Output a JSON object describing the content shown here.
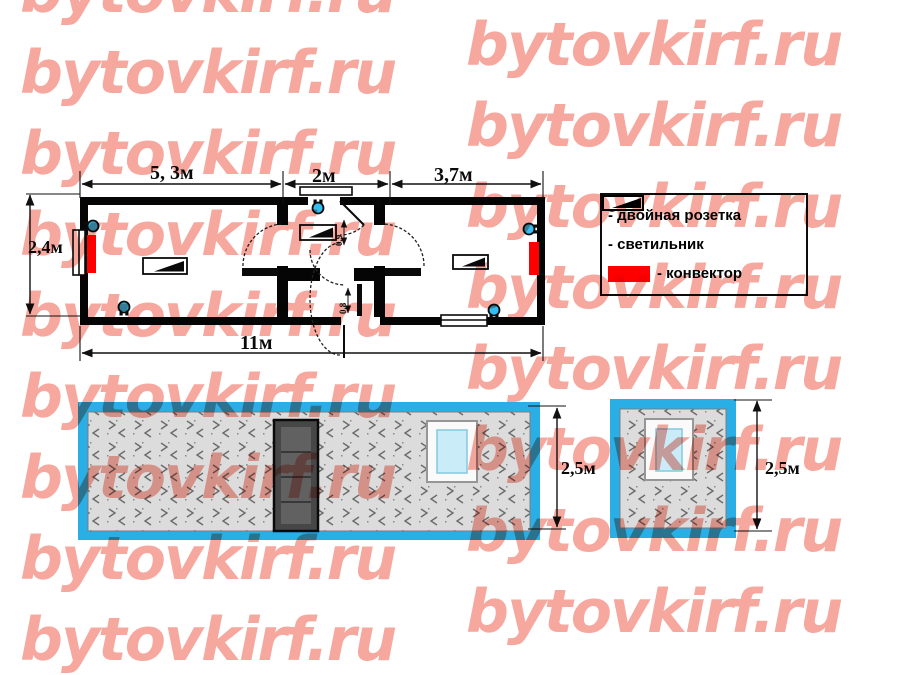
{
  "watermark": {
    "text": "bytovkirf.ru",
    "color": "#f6a89e"
  },
  "plan": {
    "dims": {
      "top_left": "5, 3м",
      "top_mid": "2м",
      "top_right": "3,7м",
      "side": "2,4м",
      "bottom": "11м",
      "door_top": "90",
      "door_hall": "0,9",
      "door_exit": "0,8"
    }
  },
  "legend": {
    "items": [
      {
        "icon": "socket-icon",
        "label": "- двойная розетка"
      },
      {
        "icon": "light-icon",
        "label": "- светильник"
      },
      {
        "icon": "convector-icon",
        "label": "- конвектор"
      }
    ]
  },
  "elevations": {
    "rear": {
      "height": "2,5м"
    },
    "end": {
      "height": "2,5м"
    }
  },
  "colors": {
    "socket": "#35bdf2",
    "convector": "#fe0000",
    "frame": "#2aaee6",
    "watermark": "#f6a89e"
  }
}
